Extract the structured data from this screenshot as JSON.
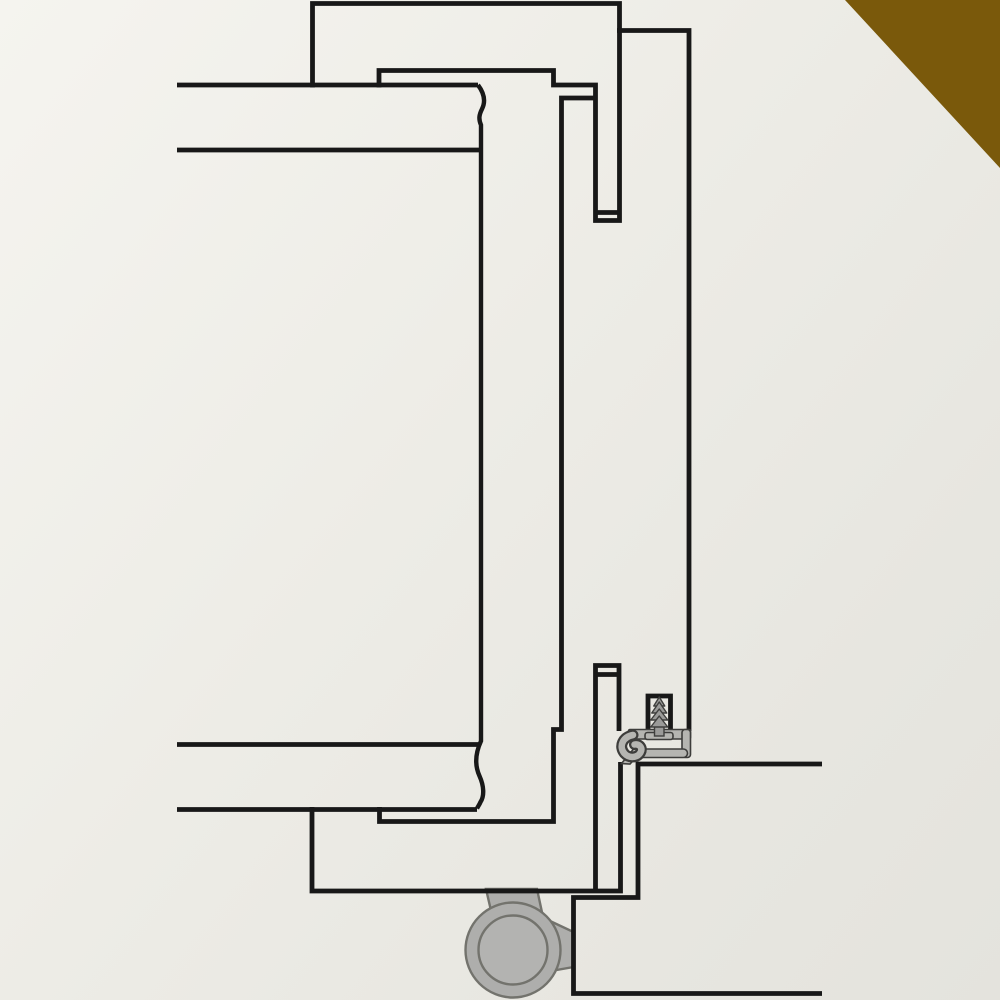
{
  "artwork": {
    "kind": "technical-cross-section-line-drawing",
    "canvas": {
      "width": 1000,
      "height": 1000
    },
    "palette": {
      "background_start": "#f5f4ef",
      "background_end": "#e4e3dd",
      "line": "#181818",
      "seal_fill": "#b5b5b1",
      "seal_outline": "#3d3d3b",
      "screw_fill": "#9b9b99",
      "screw_outline": "#3f3f3d",
      "roller_fill": "#aeaeac",
      "roller_hub_fill": "#b3b3b1",
      "roller_outline": "#73736d",
      "accent_brown": "#7a590b"
    },
    "stroke_width": 4.8,
    "corner_triangle_points": "845,0 1000,0 1000,168",
    "line_runs": [
      [
        [
          312.5,
          87.5
        ],
        [
          312.5,
          3.5
        ],
        [
          619.5,
          3.5
        ],
        [
          619.5,
          220.5
        ],
        [
          595.5,
          220.5
        ],
        [
          595.5,
          85
        ],
        [
          553.5,
          85
        ],
        [
          553.5,
          70.5
        ],
        [
          379,
          70.5
        ],
        [
          379,
          87.5
        ]
      ],
      [
        [
          617,
          30.5
        ],
        [
          689,
          30.5
        ],
        [
          689,
          731
        ]
      ],
      [
        [
          595.5,
          212.5
        ],
        [
          619.5,
          212.5
        ]
      ],
      [
        [
          593.5,
          98
        ],
        [
          561.5,
          98
        ],
        [
          561.5,
          729.5
        ],
        [
          553.5,
          729.5
        ],
        [
          553.5,
          821.5
        ],
        [
          379.5,
          821.5
        ],
        [
          379.5,
          807
        ]
      ],
      [
        [
          177,
          85
        ],
        [
          478,
          85
        ]
      ],
      [
        [
          177,
          150
        ],
        [
          480,
          150
        ]
      ],
      [
        [
          177,
          744.5
        ],
        [
          481,
          744.5
        ]
      ],
      [
        [
          177,
          809.5
        ],
        [
          477,
          809.5
        ]
      ],
      [
        [
          312,
          807
        ],
        [
          312,
          891
        ],
        [
          620.5,
          891
        ],
        [
          620.5,
          762
        ]
      ],
      [
        [
          595.5,
          891
        ],
        [
          595.5,
          665.5
        ],
        [
          619,
          665.5
        ],
        [
          619,
          731
        ]
      ],
      [
        [
          595.5,
          674.5
        ],
        [
          619,
          674.5
        ]
      ],
      [
        [
          822,
          764
        ],
        [
          638,
          764
        ],
        [
          638,
          897.5
        ],
        [
          573.5,
          897.5
        ],
        [
          573.5,
          993.5
        ],
        [
          822,
          993.5
        ]
      ],
      [
        [
          648,
          731
        ],
        [
          648,
          696
        ],
        [
          670.5,
          696
        ],
        [
          670.5,
          731
        ]
      ]
    ],
    "break_line_path": "M 478 85 C 484 93 486 101 482 109 C 479 115 478.5 119 481 125 L 481 741 C 475.5 753 474.5 765 479.5 776 C 484 786 484.5 796 480.5 802 C 479.5 804.5 478 806.5 477 808.5",
    "gasket": {
      "top_bar": {
        "x": 628.5,
        "y": 729.5,
        "w": 62,
        "h": 9.5,
        "rx": 1.5
      },
      "right_wall": {
        "x": 682,
        "y": 729.5,
        "w": 8.5,
        "h": 28,
        "rx": 3
      },
      "bottom_bar": {
        "x": 637,
        "y": 749,
        "w": 50.5,
        "h": 8.5,
        "rx": 4.2
      },
      "flange": {
        "x": 645,
        "y": 732.5,
        "w": 28,
        "h": 7,
        "rx": 2.5
      },
      "tail_points": "636,746 621.5,763.5 630,764 641,752",
      "curl_path": "M 633 735 C 622.5 737 618.5 746.5 624.5 753.5 C 629 758.5 637.5 758 640.5 752.5 C 643 748 639.5 743.5 634.5 744.5",
      "curl_outline_width": 11,
      "curl_width": 6.5
    },
    "screw": {
      "center_x": 659.25,
      "tiers": [
        {
          "apex_y": 697,
          "base_y": 706,
          "half_w": 5.5
        },
        {
          "apex_y": 702,
          "base_y": 713,
          "half_w": 7.5
        },
        {
          "apex_y": 709,
          "base_y": 720,
          "half_w": 8.5
        },
        {
          "apex_y": 716,
          "base_y": 727,
          "half_w": 8.5
        }
      ],
      "shaft": {
        "x": 654.5,
        "y": 723,
        "w": 9.5,
        "h": 13
      }
    },
    "roller": {
      "stem_points": "486,889 537,889 543,917 492,915",
      "arm_points": "533,913 573.5,932 573.5,967 545,972",
      "wheel": {
        "cx": 513,
        "cy": 950,
        "r": 47.5
      },
      "hub": {
        "cx": 513,
        "cy": 950,
        "r": 34.5
      }
    }
  }
}
